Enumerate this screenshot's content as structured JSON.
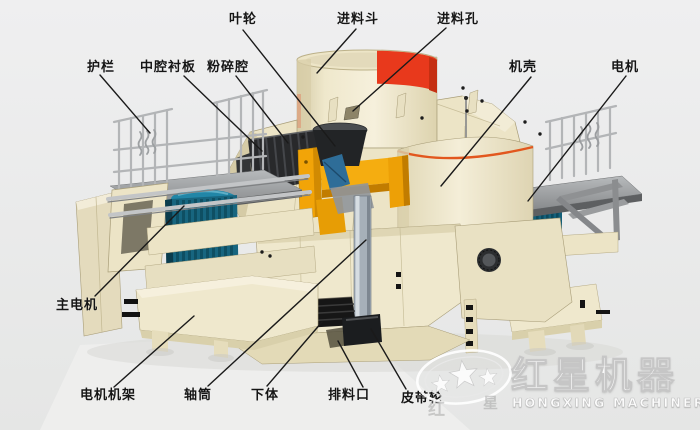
{
  "labels": {
    "impeller": "叶轮",
    "feed_hopper": "进料斗",
    "feed_hole": "进料孔",
    "guardrail": "护栏",
    "middle_cavity_liner": "中腔衬板",
    "crushing_cavity": "粉碎腔",
    "casing": "机壳",
    "motor": "电机",
    "main_motor": "主电机",
    "motor_frame": "电机机架",
    "shaft_tube": "轴筒",
    "lower_body": "下体",
    "discharge_port": "排料口",
    "belt_pulley": "皮带轮"
  },
  "logo": {
    "title": "红星机器",
    "subtitle": "HONGXING MACHINERY",
    "small_left": "红",
    "small_right": "星"
  },
  "colors": {
    "background": "#ebecec",
    "label_text": "#151515",
    "leader_line": "#1a1a1a",
    "machine_body": "#efe8cd",
    "hopper_band_red": "#e8391c",
    "rotor_orange": "#f2a408",
    "motor_teal": "#17657f",
    "casing_trim_orange": "#e2571e"
  }
}
